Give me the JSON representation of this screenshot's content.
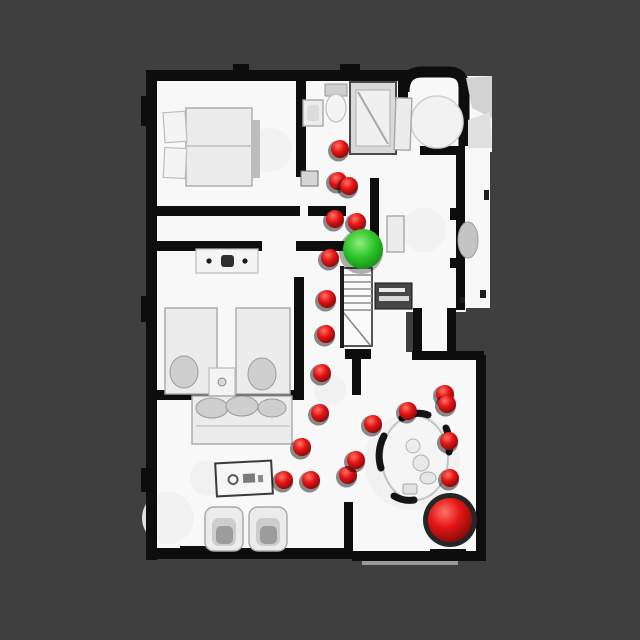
{
  "viewer": {
    "type": "3d-floorplan-top-down-view",
    "background_color": "#3f3f3f",
    "floor_color": "#f8f8f8",
    "wall_color": "#0d0d0d",
    "furniture_fill": "#ececec",
    "furniture_stroke": "#a8a8a8"
  },
  "markers": {
    "agent": {
      "label": "current-position-sphere",
      "x": 363,
      "y": 249,
      "radius": 20,
      "color": "#2ec42a"
    },
    "goal": {
      "label": "goal-position-sphere",
      "x": 450,
      "y": 520,
      "radius": 22,
      "color": "#dd1111"
    },
    "waypoints": {
      "label": "path-waypoint-spheres",
      "color": "#dd1111",
      "radius": 9,
      "points": [
        [
          340,
          149
        ],
        [
          338,
          181
        ],
        [
          349,
          186
        ],
        [
          335,
          219
        ],
        [
          357,
          222
        ],
        [
          330,
          258
        ],
        [
          327,
          299
        ],
        [
          326,
          334
        ],
        [
          322,
          373
        ],
        [
          320,
          413
        ],
        [
          302,
          447
        ],
        [
          284,
          480
        ],
        [
          311,
          480
        ],
        [
          348,
          475
        ],
        [
          356,
          460
        ],
        [
          373,
          424
        ],
        [
          408,
          411
        ],
        [
          445,
          394
        ],
        [
          447,
          404
        ],
        [
          449,
          441
        ],
        [
          450,
          478
        ]
      ]
    }
  }
}
